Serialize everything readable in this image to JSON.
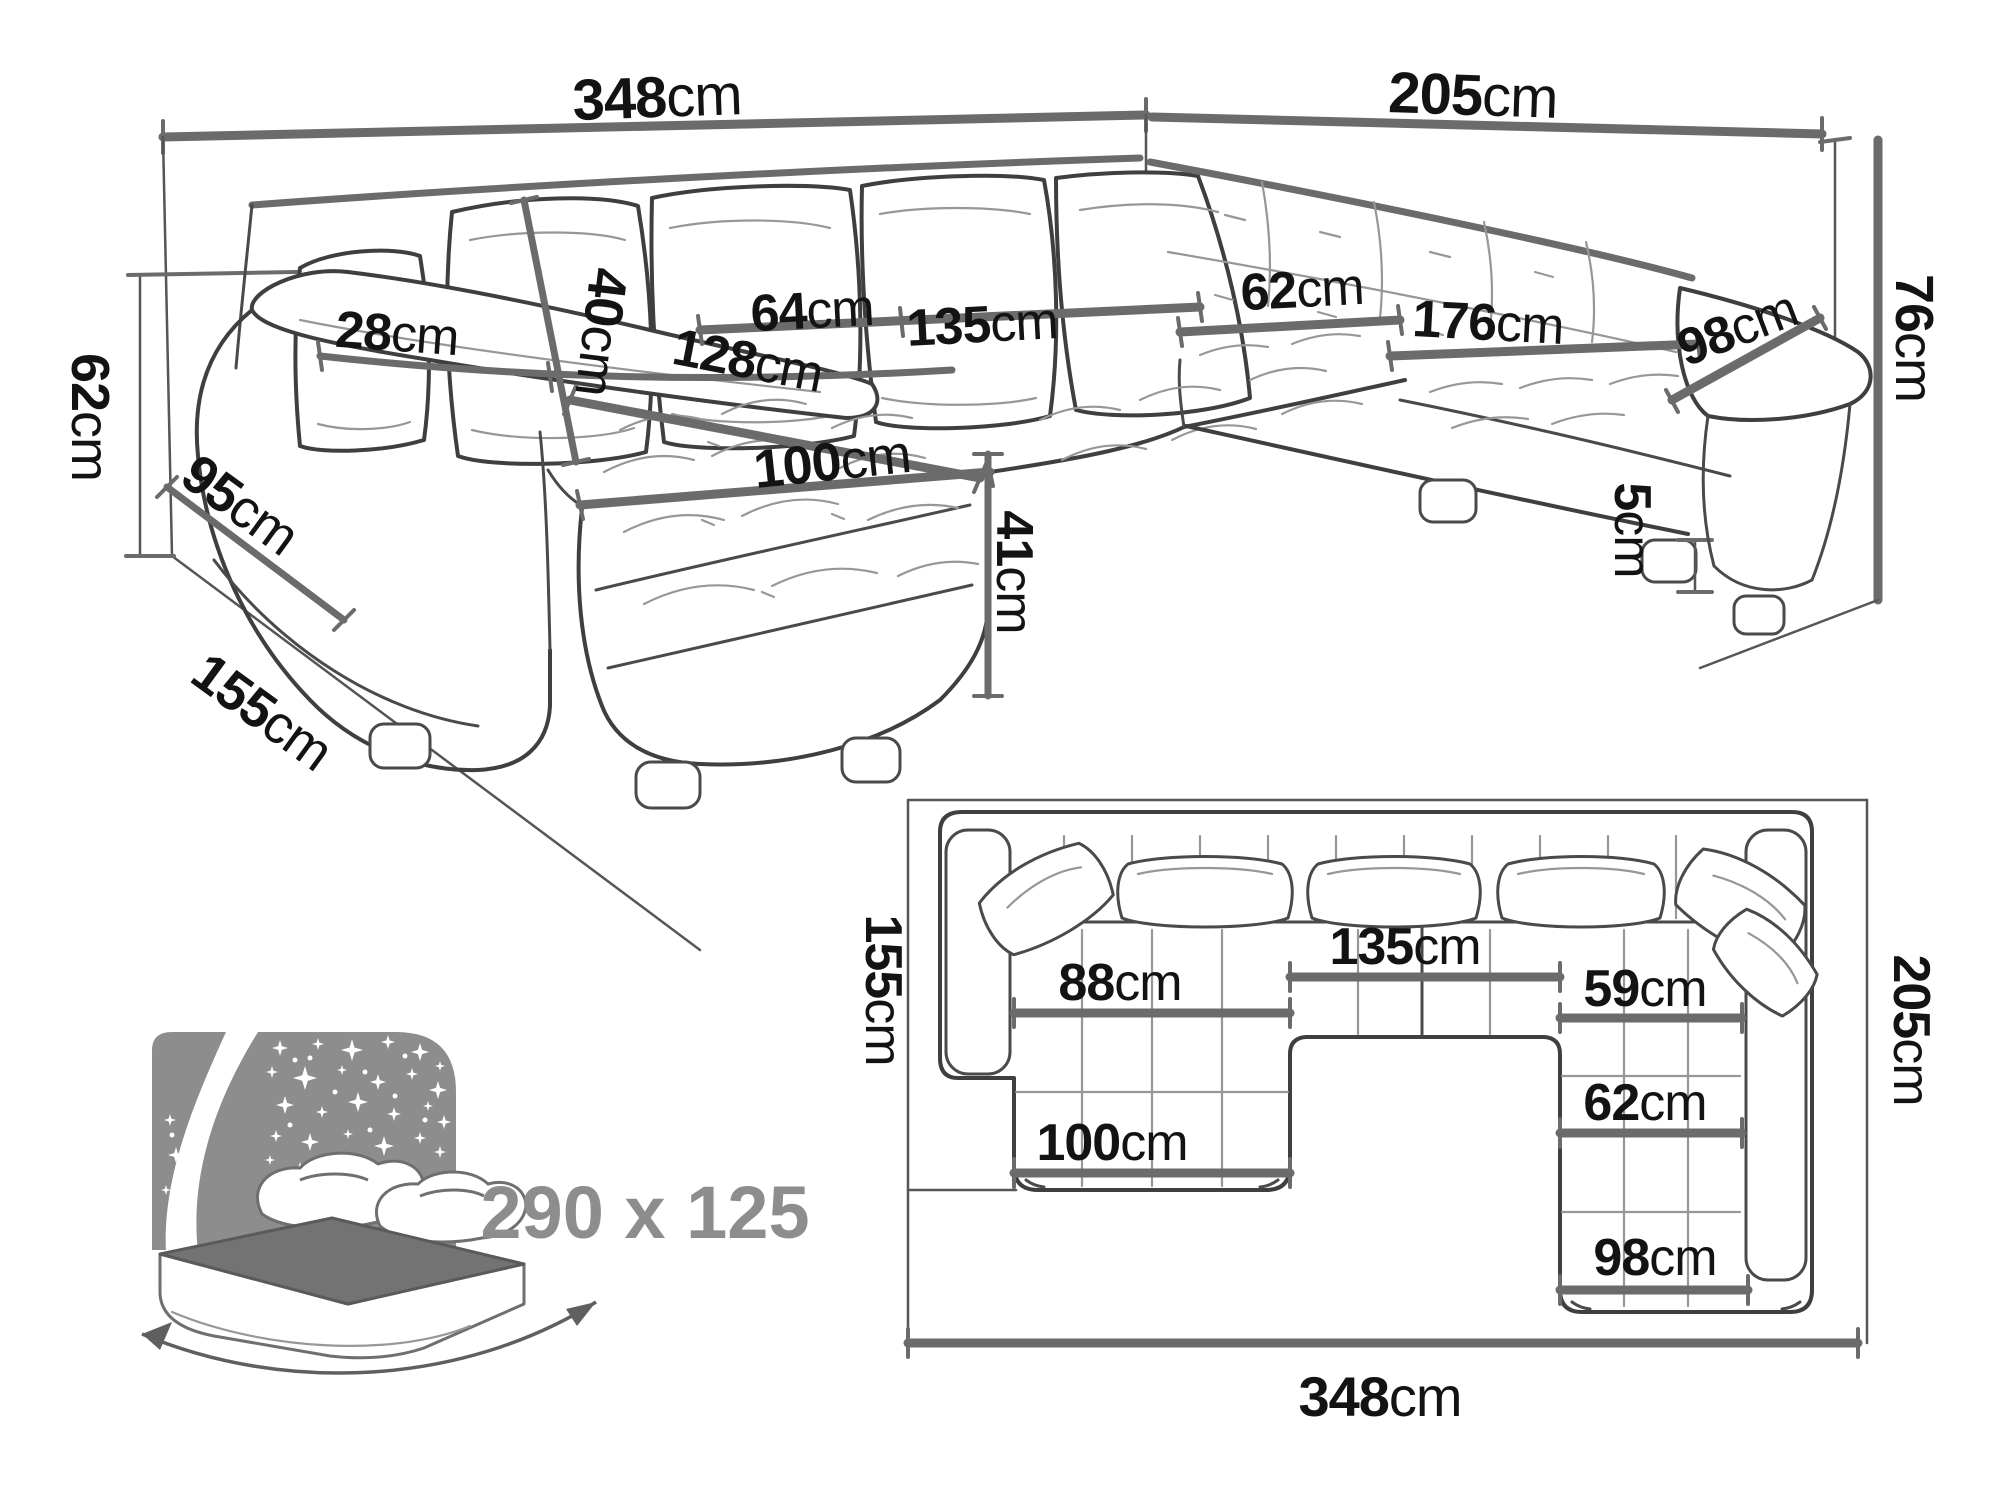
{
  "colors": {
    "line_dark": "#3f3f3f",
    "line_measure": "#6b6b6b",
    "text": "#131313",
    "gray_accent": "#8d8d8d",
    "bed_headboard": "#8d8d8d",
    "bed_mattress": "#737373",
    "background": "#ffffff"
  },
  "perspective": {
    "dims": {
      "back_width": {
        "num": "348",
        "unit": "cm"
      },
      "side_width": {
        "num": "205",
        "unit": "cm"
      },
      "armrest_height": {
        "num": "62",
        "unit": "cm"
      },
      "armrest_length": {
        "num": "95",
        "unit": "cm"
      },
      "floor_depth": {
        "num": "155",
        "unit": "cm"
      },
      "armrest_width": {
        "num": "28",
        "unit": "cm"
      },
      "cushion_height": {
        "num": "40",
        "unit": "cm"
      },
      "seat_depth_left": {
        "num": "64",
        "unit": "cm"
      },
      "seat_width_middle": {
        "num": "135",
        "unit": "cm"
      },
      "chaise_length": {
        "num": "128",
        "unit": "cm"
      },
      "corner_seat_depth": {
        "num": "62",
        "unit": "cm"
      },
      "seat_length_right": {
        "num": "176",
        "unit": "cm"
      },
      "end_seat_width": {
        "num": "98",
        "unit": "cm"
      },
      "backrest_height": {
        "num": "76",
        "unit": "cm"
      },
      "chaise_width": {
        "num": "100",
        "unit": "cm"
      },
      "seat_height": {
        "num": "41",
        "unit": "cm"
      },
      "leg_height": {
        "num": "5",
        "unit": "cm"
      }
    }
  },
  "sleeping_function": {
    "bed_size": "290 x 125"
  },
  "plan": {
    "dims": {
      "chaise_depth_total": {
        "num": "155",
        "unit": "cm"
      },
      "chaise_back_width": {
        "num": "88",
        "unit": "cm"
      },
      "middle_width": {
        "num": "135",
        "unit": "cm"
      },
      "right_seat_upper": {
        "num": "59",
        "unit": "cm"
      },
      "right_seat_mid": {
        "num": "62",
        "unit": "cm"
      },
      "chaise_front_width": {
        "num": "100",
        "unit": "cm"
      },
      "right_end_width": {
        "num": "98",
        "unit": "cm"
      },
      "right_depth_total": {
        "num": "205",
        "unit": "cm"
      },
      "total_width": {
        "num": "348",
        "unit": "cm"
      }
    }
  }
}
